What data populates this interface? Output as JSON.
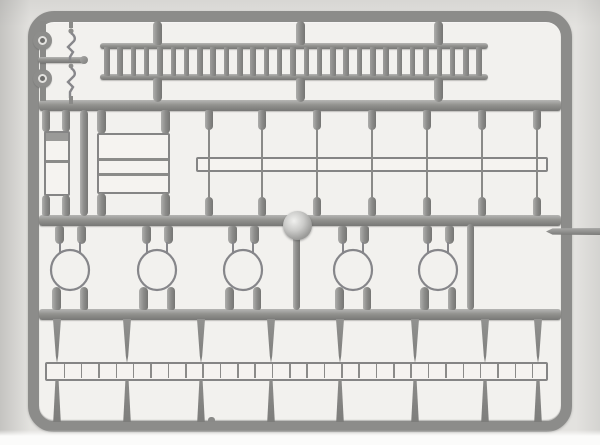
{
  "scene": {
    "type": "photograph",
    "description": "Grayscale photo of a gray injection-moulded model kit sprue (parts tree) with a long ladder, railing frames, a hollow beam, five hoop-shaped parts, two wheels, a flat ladder strip and moulding runners inside a rounded rectangular frame",
    "background_color": "#e3e2df",
    "inner_background_color": "#f2f1ee",
    "plastic_color": "#8f8f8d",
    "plastic_light": "#b6b6b4",
    "plastic_dark": "#767674",
    "knob_highlight": "#f0f0ee"
  },
  "sprue": {
    "frame": {
      "label": "rounded outer sprue frame",
      "cross_rails": 3
    },
    "parts": {
      "long_ladder": {
        "label": "long ladder",
        "rung_count": 29,
        "attachment_stubs": 3
      },
      "wheels": {
        "label": "round wheel / pulley parts",
        "count": 2
      },
      "axle_rod": {
        "label": "short axle rod with end cap"
      },
      "small_details": {
        "label": "two tiny angular detail parts on thin wire"
      },
      "small_frame": {
        "label": "narrow step frame",
        "rung_count": 1
      },
      "railing_frame": {
        "label": "wide railing frame",
        "rung_count": 2
      },
      "long_beam": {
        "label": "long hollow beam"
      },
      "thin_runners": {
        "label": "thin vertical moulding wires",
        "count": 7
      },
      "gate_knob": {
        "label": "shiny circular injection gate boss"
      },
      "hoops": {
        "label": "bell shaped hoop parts",
        "count": 5
      },
      "flat_ladder": {
        "label": "flat ladder strip",
        "cell_count": 29
      },
      "tapered_runners": {
        "label": "tapered gate runners",
        "count": 8
      },
      "side_bar": {
        "label": "bar protruding past right edge of frame"
      },
      "bottom_nub": {
        "label": "small moulding nub on bottom rail"
      }
    }
  }
}
